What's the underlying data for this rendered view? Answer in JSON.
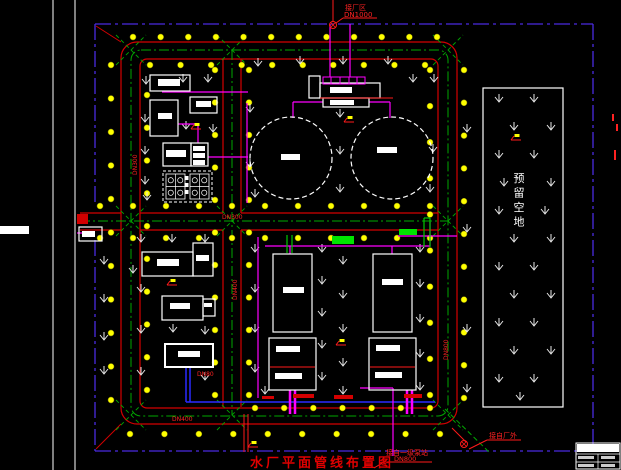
{
  "meta": {
    "title": "水厂平面管线布置图"
  },
  "colors": {
    "bg": "#000000",
    "road": "#d40000",
    "boundary": "#4a2be0",
    "centerline": "#00a800",
    "tree": "#ffff00",
    "building": "#ffffff",
    "pipe_magenta": "#ff00ff",
    "pipe_blue": "#2a2aff",
    "pipe_red": "#ff1a1a",
    "pipe_green": "#00c800",
    "green_fill": "#00e400",
    "label_red": "#ff2222",
    "grass": "#e8e8e8"
  },
  "frame": {
    "vlines": [
      53,
      75
    ],
    "white_patches": [
      [
        0,
        226,
        29,
        8
      ]
    ]
  },
  "boundary": {
    "segments": [
      [
        95,
        24,
        593,
        24
      ],
      [
        593,
        24,
        593,
        451
      ],
      [
        95,
        451,
        593,
        451
      ],
      [
        95,
        24,
        95,
        205
      ],
      [
        95,
        240,
        95,
        451
      ]
    ],
    "dash": "16 4 3 4"
  },
  "roads": {
    "outer_edge": {
      "x": 121,
      "y": 42,
      "w": 336,
      "h": 382,
      "rx": 16
    },
    "inner_edge": {
      "x": 140,
      "y": 59,
      "w": 298,
      "h": 349,
      "rx": 7
    },
    "edge_segments": [
      [
        80,
        213,
        121,
        213
      ],
      [
        140,
        213,
        223,
        213
      ],
      [
        241,
        213,
        438,
        213
      ],
      [
        80,
        230,
        121,
        230
      ],
      [
        140,
        230,
        223,
        230
      ],
      [
        241,
        230,
        438,
        230
      ],
      [
        223,
        59,
        223,
        213
      ],
      [
        223,
        230,
        223,
        407
      ],
      [
        241,
        59,
        241,
        213
      ],
      [
        241,
        230,
        241,
        407
      ]
    ],
    "corner_spurs": [
      [
        121,
        424,
        96,
        449
      ],
      [
        121,
        42,
        96,
        26
      ]
    ]
  },
  "centerlines": {
    "loop": {
      "x": 131,
      "y": 50,
      "w": 317,
      "h": 366,
      "rx": 10
    },
    "lines": [
      [
        80,
        221,
        448,
        221
      ],
      [
        232,
        50,
        232,
        415
      ]
    ],
    "x_marks": [
      [
        131,
        50
      ],
      [
        232,
        50
      ],
      [
        448,
        50
      ],
      [
        131,
        221
      ],
      [
        232,
        221
      ],
      [
        448,
        221
      ],
      [
        131,
        415
      ],
      [
        232,
        415
      ],
      [
        448,
        415
      ]
    ],
    "diagonal_exit": [
      445,
      409,
      490,
      453
    ]
  },
  "tree_lines": [
    [
      133,
      37,
      437,
      37,
      12
    ],
    [
      150,
      65,
      425,
      65,
      10
    ],
    [
      111,
      65,
      111,
      400,
      11
    ],
    [
      147,
      95,
      147,
      390,
      10
    ],
    [
      215,
      70,
      215,
      395,
      11
    ],
    [
      249,
      70,
      249,
      395,
      11
    ],
    [
      430,
      70,
      430,
      395,
      10
    ],
    [
      464,
      70,
      464,
      398,
      11
    ],
    [
      100,
      206,
      430,
      206,
      11
    ],
    [
      100,
      238,
      430,
      238,
      11
    ],
    [
      255,
      408,
      430,
      408,
      7
    ],
    [
      130,
      434,
      440,
      434,
      10
    ]
  ],
  "grass_points": [
    [
      146,
      82
    ],
    [
      183,
      80
    ],
    [
      208,
      80
    ],
    [
      145,
      120
    ],
    [
      145,
      152
    ],
    [
      145,
      182
    ],
    [
      186,
      127
    ],
    [
      213,
      130
    ],
    [
      147,
      198
    ],
    [
      258,
      64
    ],
    [
      300,
      62
    ],
    [
      343,
      62
    ],
    [
      388,
      62
    ],
    [
      413,
      80
    ],
    [
      250,
      110
    ],
    [
      250,
      165
    ],
    [
      340,
      115
    ],
    [
      340,
      152
    ],
    [
      340,
      190
    ],
    [
      434,
      80
    ],
    [
      433,
      150
    ],
    [
      255,
      195
    ],
    [
      430,
      190
    ],
    [
      467,
      130
    ],
    [
      467,
      230
    ],
    [
      467,
      330
    ],
    [
      467,
      390
    ],
    [
      141,
      240
    ],
    [
      172,
      240
    ],
    [
      205,
      240
    ],
    [
      104,
      262
    ],
    [
      133,
      271
    ],
    [
      104,
      300
    ],
    [
      141,
      290
    ],
    [
      104,
      338
    ],
    [
      141,
      331
    ],
    [
      173,
      330
    ],
    [
      205,
      332
    ],
    [
      104,
      372
    ],
    [
      141,
      373
    ],
    [
      205,
      378
    ],
    [
      255,
      250
    ],
    [
      255,
      290
    ],
    [
      255,
      330
    ],
    [
      255,
      370
    ],
    [
      322,
      250
    ],
    [
      322,
      282
    ],
    [
      322,
      314
    ],
    [
      322,
      346
    ],
    [
      322,
      378
    ],
    [
      343,
      262
    ],
    [
      343,
      296
    ],
    [
      343,
      330
    ],
    [
      343,
      364
    ],
    [
      343,
      392
    ],
    [
      265,
      392
    ],
    [
      420,
      250
    ],
    [
      420,
      285
    ],
    [
      420,
      320
    ],
    [
      420,
      355
    ],
    [
      420,
      388
    ],
    [
      499,
      100
    ],
    [
      534,
      100
    ],
    [
      514,
      128
    ],
    [
      551,
      128
    ],
    [
      499,
      156
    ],
    [
      534,
      156
    ],
    [
      504,
      184
    ],
    [
      551,
      184
    ],
    [
      499,
      212
    ],
    [
      545,
      212
    ],
    [
      514,
      240
    ],
    [
      551,
      240
    ],
    [
      499,
      268
    ],
    [
      534,
      268
    ],
    [
      514,
      296
    ],
    [
      551,
      296
    ],
    [
      499,
      324
    ],
    [
      534,
      324
    ],
    [
      514,
      352
    ],
    [
      551,
      352
    ],
    [
      499,
      380
    ],
    [
      534,
      380
    ],
    [
      520,
      398
    ]
  ],
  "buildings": [
    {
      "name": "building-small-top",
      "x": 150,
      "y": 75,
      "w": 40,
      "h": 16
    },
    {
      "name": "building-square",
      "x": 150,
      "y": 100,
      "w": 28,
      "h": 36
    },
    {
      "name": "building-small-right",
      "x": 190,
      "y": 97,
      "w": 27,
      "h": 16
    },
    {
      "name": "dosing-building-left",
      "x": 163,
      "y": 143,
      "w": 28,
      "h": 23
    },
    {
      "name": "dosing-building-right",
      "x": 191,
      "y": 143,
      "w": 17,
      "h": 23
    },
    {
      "name": "gate-house",
      "x": 79,
      "y": 227,
      "w": 23,
      "h": 14
    },
    {
      "name": "office-building-main",
      "x": 142,
      "y": 252,
      "w": 51,
      "h": 24
    },
    {
      "name": "office-building-wing",
      "x": 193,
      "y": 243,
      "w": 20,
      "h": 33
    },
    {
      "name": "workshop-main",
      "x": 162,
      "y": 296,
      "w": 41,
      "h": 24
    },
    {
      "name": "workshop-wing",
      "x": 203,
      "y": 299,
      "w": 12,
      "h": 17
    },
    {
      "name": "pump-house",
      "x": 165,
      "y": 344,
      "w": 48,
      "h": 23,
      "bold": true
    },
    {
      "name": "basin-1",
      "x": 273,
      "y": 254,
      "w": 39,
      "h": 78
    },
    {
      "name": "basin-2",
      "x": 373,
      "y": 254,
      "w": 39,
      "h": 78
    },
    {
      "name": "basin-3",
      "x": 269,
      "y": 338,
      "w": 47,
      "h": 52
    },
    {
      "name": "basin-4",
      "x": 369,
      "y": 338,
      "w": 47,
      "h": 52
    },
    {
      "name": "top-building-wing",
      "x": 309,
      "y": 76,
      "w": 11,
      "h": 22
    },
    {
      "name": "top-building-main",
      "x": 320,
      "y": 83,
      "w": 60,
      "h": 15
    },
    {
      "name": "top-building-lower",
      "x": 323,
      "y": 98,
      "w": 46,
      "h": 9
    },
    {
      "name": "reserved-area",
      "x": 483,
      "y": 88,
      "w": 80,
      "h": 319
    }
  ],
  "label_bars": [
    [
      158,
      79,
      22,
      7
    ],
    [
      158,
      113,
      14,
      6
    ],
    [
      196,
      101,
      15,
      6
    ],
    [
      166,
      150,
      20,
      7
    ],
    [
      193,
      146,
      12,
      5
    ],
    [
      193,
      153,
      12,
      5
    ],
    [
      193,
      160,
      12,
      5
    ],
    [
      330,
      87,
      22,
      6
    ],
    [
      330,
      100,
      24,
      5
    ],
    [
      281,
      154,
      19,
      6
    ],
    [
      377,
      147,
      20,
      6
    ],
    [
      82,
      231,
      13,
      6
    ],
    [
      157,
      259,
      22,
      7
    ],
    [
      196,
      255,
      13,
      6
    ],
    [
      170,
      303,
      20,
      6
    ],
    [
      204,
      303,
      8,
      4
    ],
    [
      178,
      351,
      22,
      6
    ],
    [
      283,
      287,
      21,
      6
    ],
    [
      382,
      279,
      21,
      6
    ],
    [
      276,
      346,
      24,
      6
    ],
    [
      275,
      373,
      27,
      6
    ],
    [
      376,
      345,
      24,
      6
    ],
    [
      375,
      372,
      27,
      6
    ]
  ],
  "tanks": [
    {
      "name": "clearwater-tank-1",
      "cx": 291,
      "cy": 158,
      "r": 41
    },
    {
      "name": "clearwater-tank-2",
      "cx": 392,
      "cy": 158,
      "r": 41
    }
  ],
  "filter_structure": {
    "x": 163,
    "y": 171,
    "w": 49,
    "h": 31,
    "inner": [
      [
        166,
        174,
        19,
        25
      ],
      [
        190,
        174,
        19,
        25
      ]
    ],
    "mid_boxes": [
      [
        184.5,
        176,
        4,
        4
      ],
      [
        184.5,
        183,
        4,
        4
      ],
      [
        184.5,
        190,
        4,
        4
      ]
    ]
  },
  "magenta_box_row": {
    "x": 323,
    "y": 77,
    "w": 42,
    "h": 7,
    "dividers": [
      331,
      340,
      349,
      357
    ]
  },
  "pipes": {
    "magenta": [
      [
        330,
        24,
        330,
        77
      ],
      [
        350,
        24,
        350,
        77
      ],
      [
        323,
        102,
        293,
        102
      ],
      [
        293,
        102,
        293,
        118
      ],
      [
        369,
        102,
        390,
        102
      ],
      [
        390,
        102,
        390,
        118
      ],
      [
        247,
        103,
        247,
        203
      ],
      [
        162,
        92,
        248,
        92
      ],
      [
        178,
        124,
        198,
        124
      ],
      [
        198,
        124,
        198,
        143
      ],
      [
        208,
        157,
        248,
        157
      ],
      [
        265,
        246,
        430,
        246
      ],
      [
        290,
        246,
        290,
        254
      ],
      [
        392,
        246,
        392,
        254
      ],
      [
        258,
        237,
        258,
        398
      ],
      [
        430,
        222,
        430,
        246
      ],
      [
        398,
        236,
        457,
        236
      ],
      [
        360,
        388,
        393,
        388
      ],
      [
        393,
        388,
        393,
        456
      ],
      [
        77,
        233,
        88,
        233
      ]
    ],
    "magenta_thick": [
      [
        290,
        390,
        290,
        414
      ],
      [
        295,
        390,
        295,
        414
      ],
      [
        407,
        390,
        407,
        414
      ],
      [
        412,
        390,
        412,
        414
      ]
    ],
    "blue": [
      [
        186,
        367,
        186,
        402
      ],
      [
        190,
        367,
        190,
        402
      ],
      [
        186,
        402,
        435,
        402
      ]
    ],
    "red": [
      [
        333,
        0,
        333,
        22
      ],
      [
        320,
        98,
        393,
        98
      ],
      [
        270,
        367,
        315,
        367
      ],
      [
        370,
        367,
        415,
        367
      ],
      [
        244,
        414,
        244,
        452
      ],
      [
        248,
        414,
        248,
        452
      ],
      [
        343,
        18,
        377,
        18
      ],
      [
        336,
        23,
        343,
        18
      ],
      [
        384,
        462,
        432,
        462
      ],
      [
        374,
        468,
        384,
        462
      ],
      [
        487,
        440,
        521,
        440
      ],
      [
        469,
        449,
        487,
        440
      ],
      [
        452,
        428,
        466,
        442
      ]
    ],
    "green": [
      [
        287,
        235,
        287,
        253
      ],
      [
        292,
        235,
        292,
        253
      ],
      [
        424,
        218,
        424,
        247
      ],
      [
        430,
        218,
        430,
        247
      ],
      [
        424,
        218,
        430,
        218
      ]
    ]
  },
  "fills": {
    "green": [
      [
        332,
        236,
        22,
        8
      ],
      [
        399,
        229,
        18,
        6
      ]
    ],
    "red": [
      [
        262,
        396,
        12,
        3
      ],
      [
        293,
        394,
        21,
        4
      ],
      [
        334,
        395,
        19,
        4
      ],
      [
        404,
        394,
        18,
        4
      ],
      [
        77,
        214,
        11,
        10
      ]
    ],
    "red_ticks": [
      [
        612,
        114,
        2,
        7
      ],
      [
        616,
        124,
        2,
        7
      ],
      [
        614,
        150,
        2,
        10
      ]
    ]
  },
  "labels": [
    {
      "text": "接厂区",
      "x": 345,
      "y": 10,
      "size": 7,
      "vertical": false
    },
    {
      "text": "DN1000",
      "x": 344,
      "y": 17,
      "size": 7,
      "vertical": false
    },
    {
      "text": "接自一级泵站",
      "x": 386,
      "y": 455,
      "size": 7,
      "vertical": false
    },
    {
      "text": "DN800",
      "x": 394,
      "y": 461,
      "size": 6.5,
      "vertical": false
    },
    {
      "text": "接自厂外",
      "x": 489,
      "y": 438,
      "size": 7,
      "vertical": false
    },
    {
      "text": "DN300",
      "x": 222,
      "y": 219,
      "size": 6,
      "vertical": false
    },
    {
      "text": "DN300",
      "x": 137,
      "y": 175,
      "size": 6,
      "vertical": true
    },
    {
      "text": "DN400",
      "x": 237,
      "y": 300,
      "size": 6,
      "vertical": true
    },
    {
      "text": "DN800",
      "x": 448,
      "y": 360,
      "size": 6,
      "vertical": true
    },
    {
      "text": "DN80",
      "x": 197,
      "y": 376,
      "size": 6,
      "vertical": false
    },
    {
      "text": "DN400",
      "x": 172,
      "y": 421,
      "size": 6,
      "vertical": false
    }
  ],
  "reserved_text": {
    "chars": [
      "预",
      "留",
      "空",
      "地"
    ],
    "x": 519,
    "y0": 182,
    "dy": 14.5,
    "size": 11
  },
  "symbols": {
    "valves": [
      [
        333,
        25
      ],
      [
        464,
        444
      ]
    ],
    "hydrants": [
      [
        196,
        127
      ],
      [
        349,
        120
      ],
      [
        516,
        138
      ],
      [
        172,
        283
      ],
      [
        341,
        343
      ],
      [
        253,
        445
      ]
    ]
  },
  "titleblock": {
    "outer": [
      576,
      443,
      44,
      26
    ],
    "header_fill": [
      577,
      444,
      42,
      8
    ],
    "hlines": [
      [
        576,
        454,
        620,
        454
      ],
      [
        576,
        462,
        620,
        462
      ]
    ],
    "vline": [
      598,
      454,
      598,
      469
    ],
    "text_marks": [
      [
        578,
        456,
        16,
        3
      ],
      [
        601,
        456,
        14,
        3
      ],
      [
        578,
        464,
        16,
        3
      ],
      [
        601,
        464,
        14,
        3
      ]
    ]
  }
}
